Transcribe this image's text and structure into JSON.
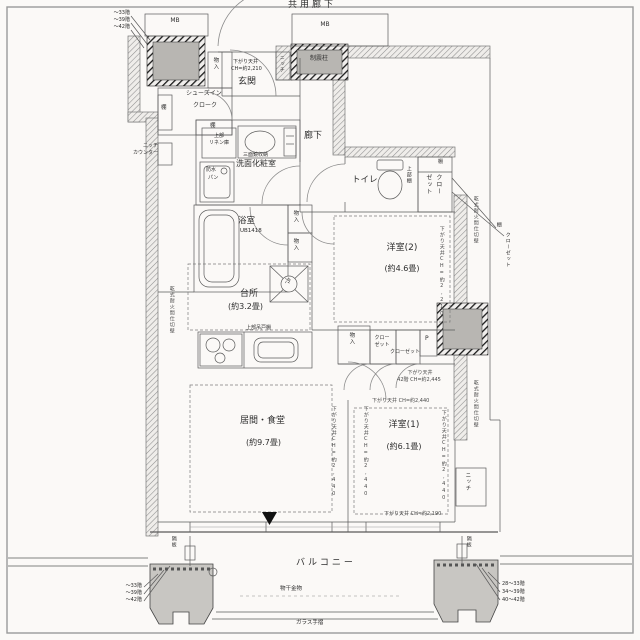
{
  "plan": {
    "common_corridor": "共用廊下",
    "mb": "MB",
    "seismic_column": "制震柱",
    "entrance": "玄関",
    "hall": "廊下",
    "storage": "物入",
    "niche": "ニッチ",
    "shelf": "棚",
    "sic_line1": "シューズイン",
    "sic_line2": "クローク",
    "niche_counter_1": "ニッチ",
    "niche_counter_2": "カウンター",
    "linen_1": "上部",
    "linen_2": "リネン庫",
    "mirror_cabinet": "三面鏡収納",
    "powder_room": "洗面化粧室",
    "pan_1": "防水",
    "pan_2": "パン",
    "toilet": "トイレ",
    "upper_shelf": "上部棚",
    "closet": "クローゼット",
    "closet_col_1": "クロー",
    "closet_col_2": "ゼット",
    "bath": "浴室",
    "bath_ub": "UB1418",
    "kitchen": "台所",
    "kitchen_size": "(約3.2畳)",
    "fridge": "冷",
    "upper_cabinet": "上部吊戸棚",
    "bedroom2": "洋室(2)",
    "bedroom2_size": "(約4.6畳)",
    "bedroom1": "洋室(1)",
    "bedroom1_size": "(約6.1畳)",
    "living": "居間・食堂",
    "living_size": "(約9.7畳)",
    "pipe_space": "P",
    "dry_wall": "乾式耐火間仕切壁",
    "ceiling_entry_1": "下がり天井",
    "ceiling_entry_2": "CH=約2,210",
    "ceiling_2210_v": "下がり天井CH=約2,210",
    "ceiling_2440_v": "下がり天井CH=約2,440",
    "ceiling_2440_h": "下がり天井 CH=約2,440",
    "ceiling_42f_1": "下がり天井",
    "ceiling_42f_2": "42階 CH=約2,445",
    "ceiling_2190": "下がり天井 CH=約2,190",
    "partition_board": "隔板",
    "balcony": "バルコニー",
    "laundry_fitting": "物干金物",
    "glass_rail": "ガラス手摺",
    "floors_topleft": [
      "〜33階",
      "〜39階",
      "〜42階"
    ],
    "floors_left": [
      "〜33階",
      "〜39階",
      "〜42階"
    ],
    "floors_right": [
      "28〜33階",
      "34〜39階",
      "40〜42階"
    ]
  }
}
